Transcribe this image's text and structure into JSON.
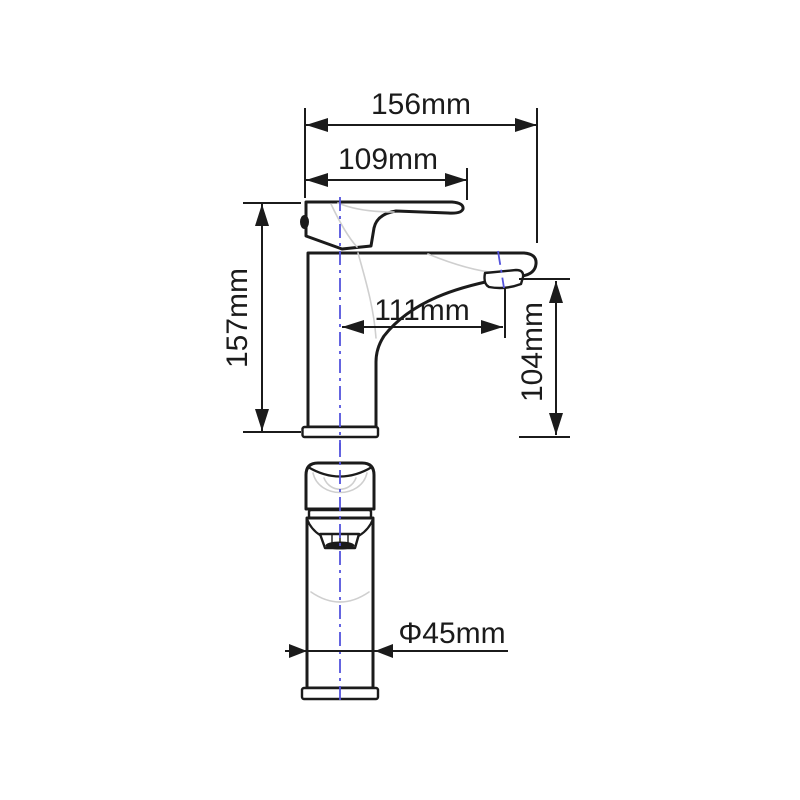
{
  "dimensions": {
    "overall_width": "156mm",
    "handle_width": "109mm",
    "total_height": "157mm",
    "spout_reach": "111mm",
    "spout_height": "104mm",
    "base_diameter": "Φ45mm"
  },
  "colors": {
    "line": "#1b1b1b",
    "centerline": "#5353dc",
    "shading": "#cfcfcf",
    "bg": "#ffffff"
  }
}
